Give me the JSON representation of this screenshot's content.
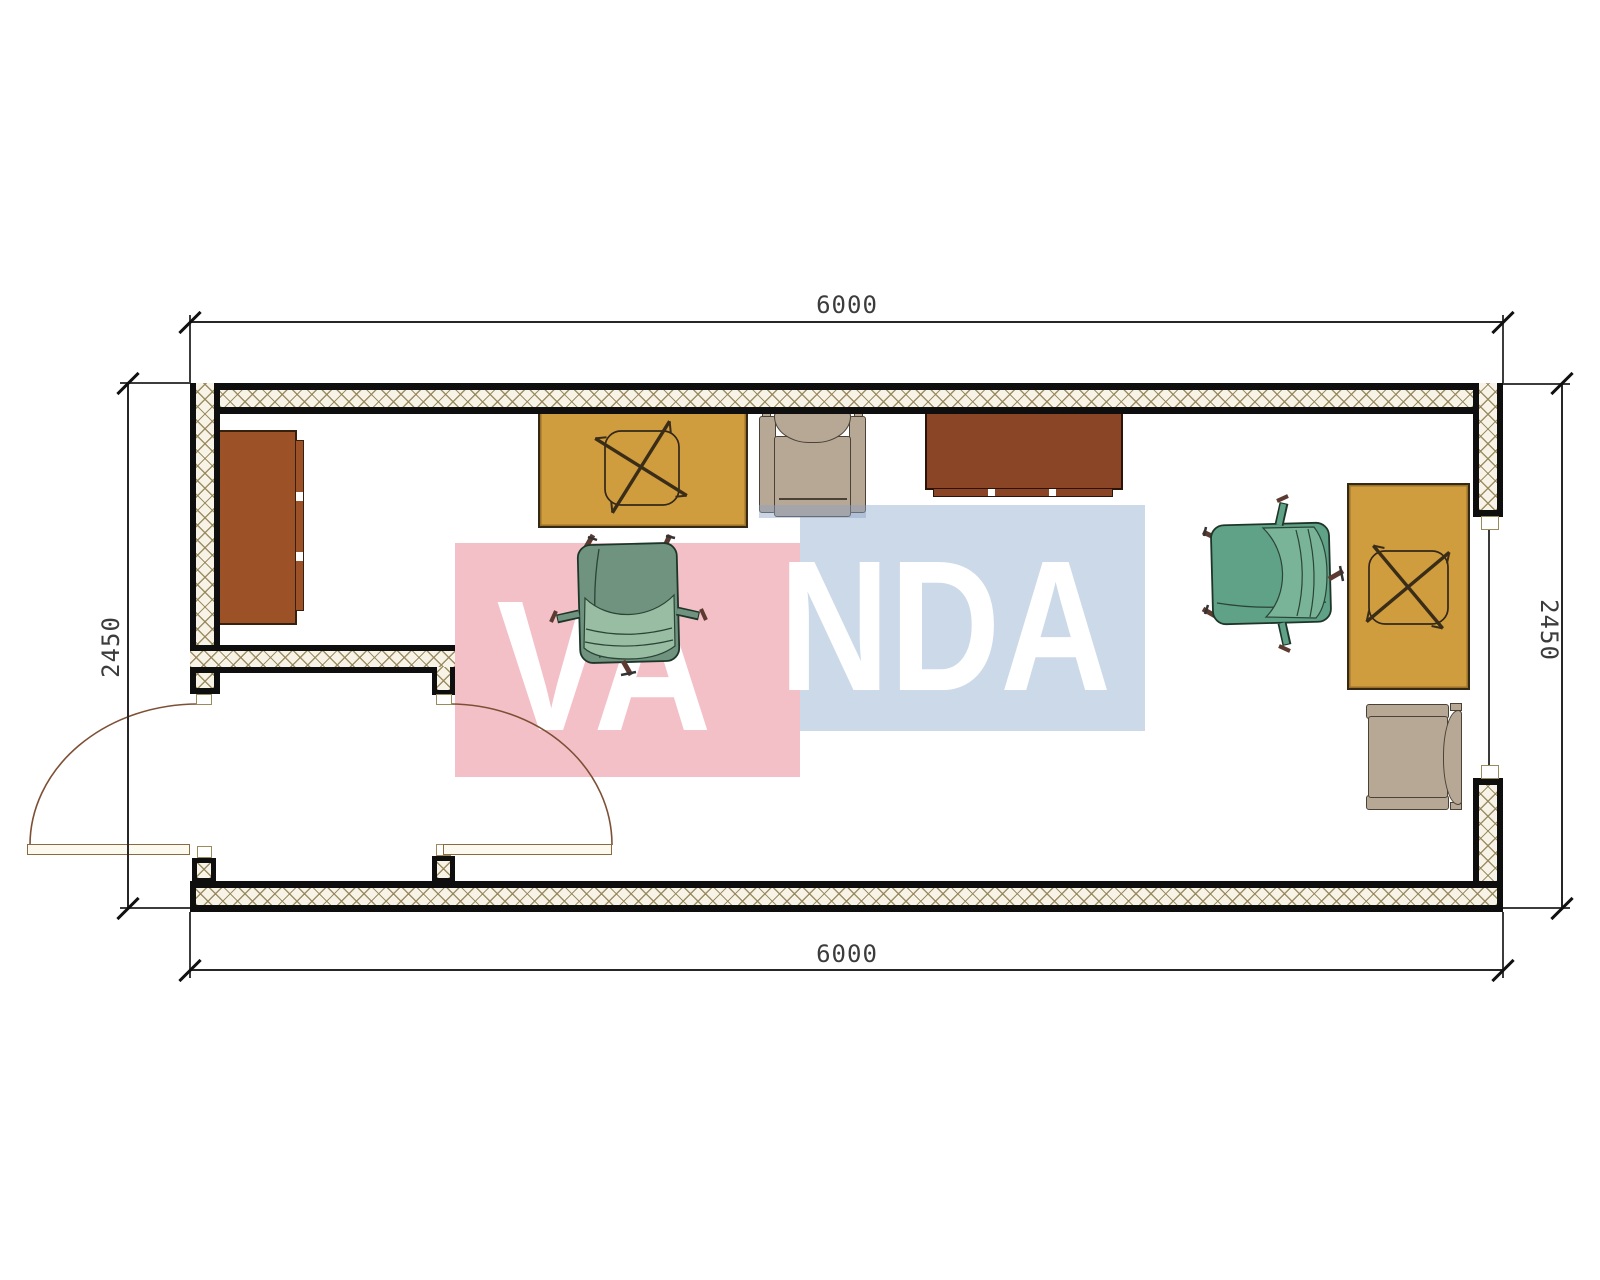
{
  "drawing": {
    "type": "floor-plan",
    "dimensions": {
      "top": "6000",
      "bottom": "6000",
      "left": "2450",
      "right": "2450"
    },
    "watermark": {
      "text": "VANDA",
      "left_part": "VA",
      "right_part": "NDA"
    },
    "furniture": [
      "storage-cabinet",
      "office-desk-left",
      "lounge-chair-left",
      "sideboard",
      "office-chair-left",
      "office-chair-right",
      "office-desk-right",
      "lounge-chair-right",
      "double-entry-door",
      "window"
    ],
    "colors": {
      "wall_fill": "#f7f3e6",
      "hatch": "#94835a",
      "line": "#0e0e0e",
      "desk": "#cf9c3e",
      "cabinet_left": "#9c5127",
      "cabinet_top": "#8a4527",
      "armchair": "#b7a896",
      "chair_green": "#5fa287",
      "chair_green_muted": "#6f937e",
      "chair_seat_light": "#98bda2",
      "watermark_pink": "#f4c0c8",
      "watermark_blue": "#ccd9e9",
      "watermark_text": "#ffffff",
      "door_arc": "#7d4f35",
      "dim_text": "#3c3c3c"
    }
  }
}
